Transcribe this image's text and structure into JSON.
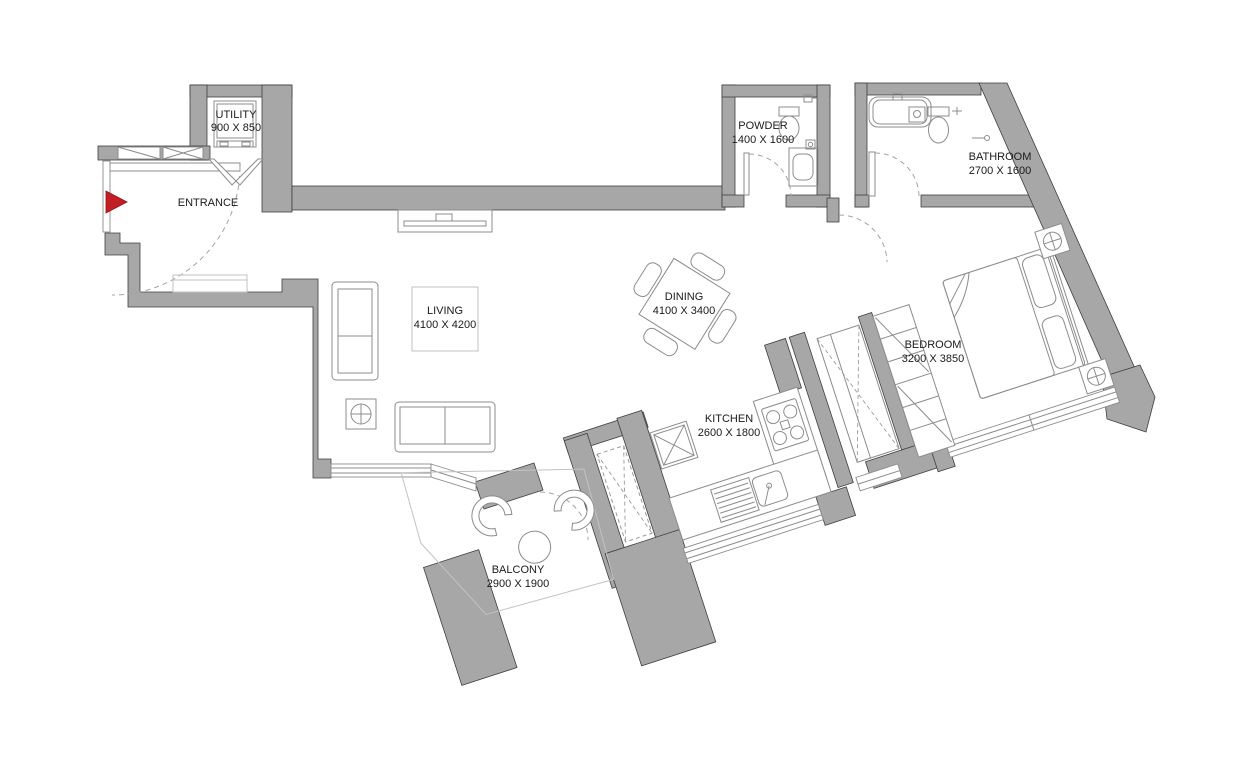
{
  "title": "Apartment Floor Plan",
  "colors": {
    "wall": "#a7a7a7",
    "wall_edge": "#3f3f3f",
    "furniture_line": "#8c8c8c",
    "ink": "#1a1a1a",
    "entry_marker": "#c41e25",
    "background": "#ffffff"
  },
  "rooms": [
    {
      "name": "UTILITY",
      "dims": "900 X 850"
    },
    {
      "name": "ENTRANCE",
      "dims": ""
    },
    {
      "name": "POWDER",
      "dims": "1400 X 1600"
    },
    {
      "name": "BATHROOM",
      "dims": "2700 X 1600"
    },
    {
      "name": "LIVING",
      "dims": "4100 X 4200"
    },
    {
      "name": "DINING",
      "dims": "4100 X 3400"
    },
    {
      "name": "KITCHEN",
      "dims": "2600 X 1800"
    },
    {
      "name": "BEDROOM",
      "dims": "3200 X 3850"
    },
    {
      "name": "BALCONY",
      "dims": "2900 X 1900"
    }
  ]
}
